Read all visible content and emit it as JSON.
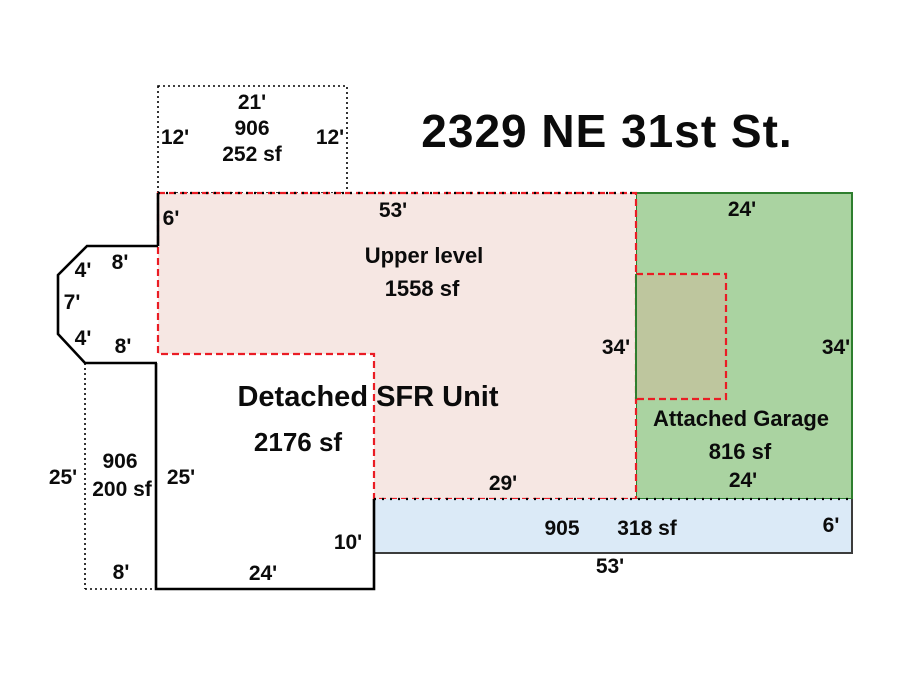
{
  "title": "2329 NE 31st St.",
  "colors": {
    "pink_fill": "#f6e7e3",
    "red_dash": "#ea1c24",
    "green_fill": "#aad3a1",
    "green_border": "#2e7e2e",
    "green_text": "#169016",
    "tan_fill": "#bec69e",
    "blue_fill": "#dbeaf7",
    "blue_border": "#3c3c3c",
    "line": "#000000"
  },
  "addition_906_top": {
    "width": "21'",
    "code": "906",
    "area": "252 sf",
    "left": "12'",
    "right": "12'"
  },
  "upper_level": {
    "name": "Upper level",
    "area": "1558 sf",
    "top": "53'",
    "left_offset": "6'",
    "right": "34'",
    "bottom": "29'"
  },
  "garage": {
    "name": "Attached Garage",
    "area": "816 sf",
    "top": "24'",
    "bottom": "24'",
    "right": "34'"
  },
  "bay": {
    "top": "8'",
    "top_diag": "4'",
    "left": "7'",
    "bottom_diag": "4'",
    "bottom": "8'"
  },
  "sfr": {
    "name": "Detached SFR Unit",
    "area": "2176 sf",
    "left": "25'",
    "right": "10'",
    "bottom": "24'"
  },
  "addition_906_left": {
    "outside": "25'",
    "code": "906",
    "area": "200 sf",
    "bottom": "8'"
  },
  "porch_905": {
    "code": "905",
    "area": "318 sf",
    "right": "6'",
    "bottom": "53'"
  }
}
